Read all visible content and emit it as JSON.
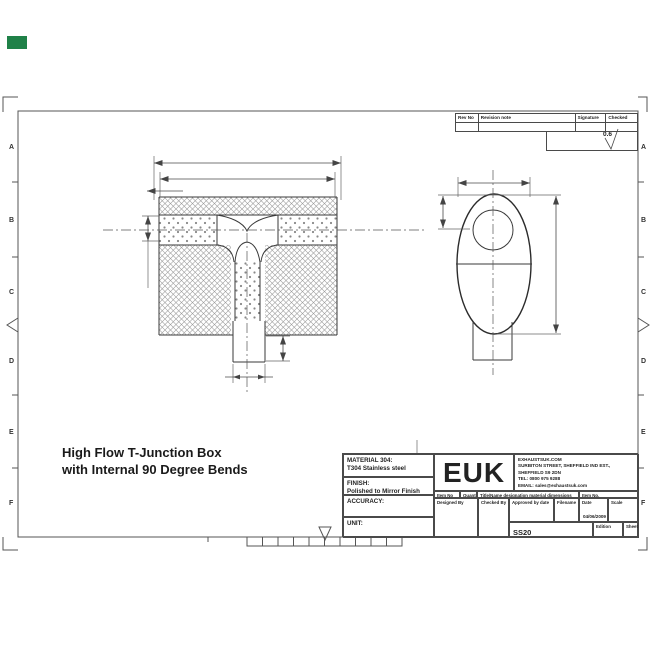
{
  "sheet": {
    "marker_color": "#1f8148"
  },
  "frame": {
    "zone_letters": [
      "A",
      "B",
      "C",
      "D",
      "E",
      "F"
    ]
  },
  "revision_table": {
    "rev_no": "Rev No",
    "revision_note": "Revision note",
    "signature": "Signature",
    "checked": "Checked",
    "surface_finish": "0.6"
  },
  "drawing_title": {
    "line1": "High Flow T-Junction Box",
    "line2": "with Internal 90 Degree Bends"
  },
  "title_block": {
    "material_label": "MATERIAL 304:",
    "material_value": "T304 Stainless steel",
    "finish_label": "FINISH:",
    "finish_value": "Polished to Mirror Finish",
    "accuracy_label": "ACCURACY:",
    "unit_label": "UNIT:",
    "logo": "EUK",
    "company_lines": {
      "l1": "EXHAUSTSUK.COM",
      "l2": "SURBITON STREET, SHEFFIELD IND EST.,",
      "l3": "SHEFFIELD S9 2DN",
      "l4": "TEL: 0800 975 9288",
      "l5": "EMAIL: sales@exhaustsuk.com"
    },
    "item_no_label": "Item No",
    "quantity_label": "Quantity",
    "designation_label": "Title/Name designation material dimensions",
    "item_no2_label": "Item No.",
    "designed_label": "Designed By",
    "checked_label": "Checked By",
    "approved_label": "Approved by date",
    "filename_label": "Filename",
    "date_label": "Date",
    "date_value": "04/06/2009",
    "scale_label": "Scale",
    "part_number": "SS20",
    "edition_label": "Edition",
    "sheet_label": "Sheet"
  }
}
